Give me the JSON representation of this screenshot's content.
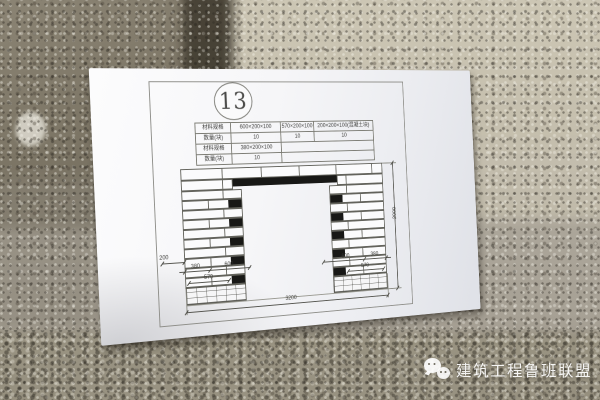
{
  "drawing": {
    "sheet_number": "13",
    "spec_table": {
      "rows": [
        {
          "label": "材料规格",
          "cells": [
            "600×200×100",
            "570×200×100",
            "200×200×100(混凝土块)"
          ]
        },
        {
          "label": "数量(块)",
          "cells": [
            "10",
            "10",
            "10"
          ]
        },
        {
          "label": "材料规格",
          "cells": [
            "380×200×100",
            ""
          ]
        },
        {
          "label": "数量(块)",
          "cells": [
            "10",
            ""
          ]
        }
      ]
    },
    "wall": {
      "courses": 10,
      "black_on_even_courses": true
    },
    "dims": {
      "left_block": "200",
      "left_a": "380",
      "left_b": "600",
      "left_c": "570",
      "right_a": "600",
      "right_b": "380",
      "right_c": "570",
      "overall_width": "3200",
      "overall_height": "2000"
    }
  },
  "watermark": {
    "icon": "wechat-icon",
    "text": "建筑工程鲁班联盟"
  },
  "colors": {
    "paper": "#f2f2f5",
    "drawing_line": "#63635c",
    "block_fill": "#181816",
    "wall_light": "#c2bcab",
    "wall_dark": "#6d6758",
    "watermark_text": "#ffffff"
  }
}
